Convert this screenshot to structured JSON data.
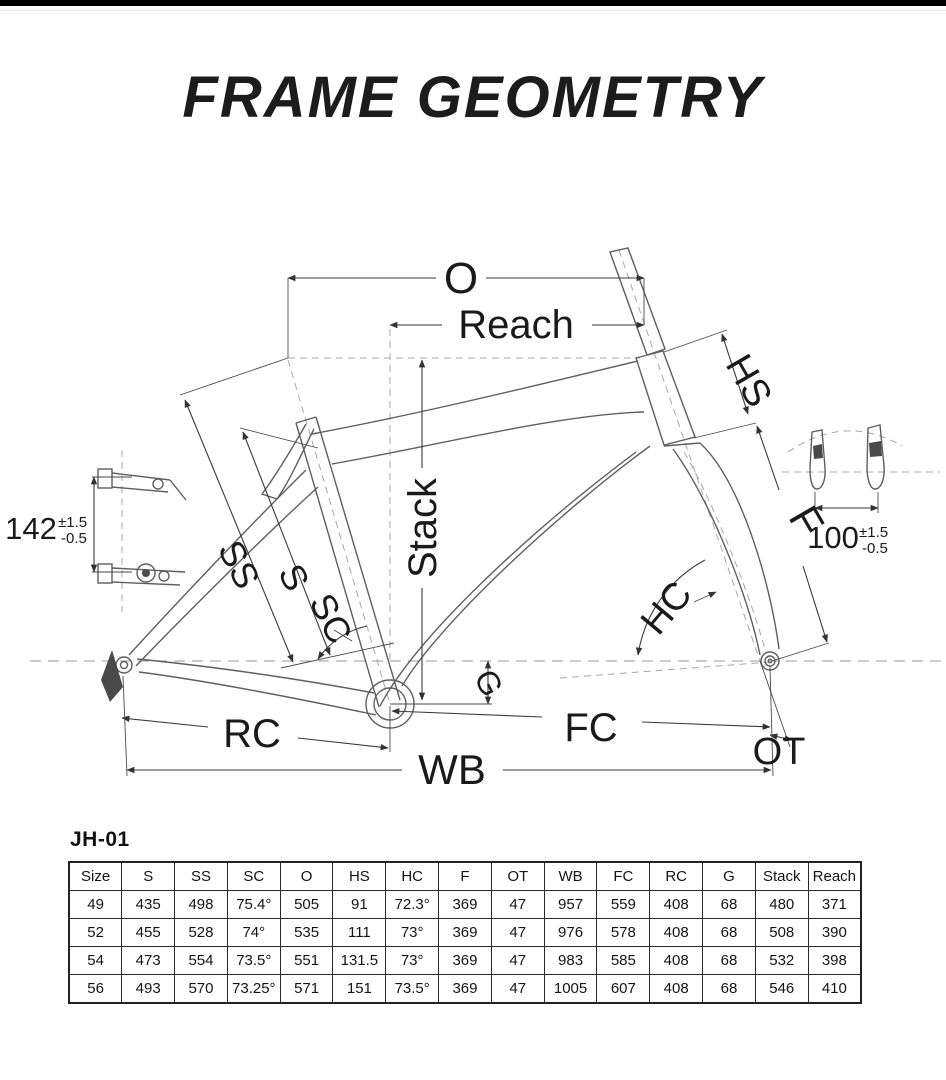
{
  "page": {
    "title": "FRAME GEOMETRY"
  },
  "colors": {
    "background": "#ffffff",
    "top_bar": "#000000",
    "ink": "#1a1a1a",
    "frame_line": "#5f5f5f",
    "dim_line": "#3a3a3a",
    "dash_line": "#9a9a9a"
  },
  "diagram": {
    "dims": {
      "o": "O",
      "reach": "Reach",
      "hs": "HS",
      "f": "F",
      "stack": "Stack",
      "ss": "SS",
      "s": "S",
      "sc": "SC",
      "g": "G",
      "hc": "HC",
      "rc": "RC",
      "fc": "FC",
      "ot": "OT",
      "wb": "WB"
    },
    "rear_hub": {
      "value": "142",
      "tol_plus": "±1.5",
      "tol_minus": "-0.5"
    },
    "front_hub": {
      "value": "100",
      "tol_plus": "±1.5",
      "tol_minus": "-0.5"
    }
  },
  "table": {
    "model": "JH-01",
    "columns": [
      "Size",
      "S",
      "SS",
      "SC",
      "O",
      "HS",
      "HC",
      "F",
      "OT",
      "WB",
      "FC",
      "RC",
      "G",
      "Stack",
      "Reach"
    ],
    "rows": [
      [
        "49",
        "435",
        "498",
        "75.4°",
        "505",
        "91",
        "72.3°",
        "369",
        "47",
        "957",
        "559",
        "408",
        "68",
        "480",
        "371"
      ],
      [
        "52",
        "455",
        "528",
        "74°",
        "535",
        "111",
        "73°",
        "369",
        "47",
        "976",
        "578",
        "408",
        "68",
        "508",
        "390"
      ],
      [
        "54",
        "473",
        "554",
        "73.5°",
        "551",
        "131.5",
        "73°",
        "369",
        "47",
        "983",
        "585",
        "408",
        "68",
        "532",
        "398"
      ],
      [
        "56",
        "493",
        "570",
        "73.25°",
        "571",
        "151",
        "73.5°",
        "369",
        "47",
        "1005",
        "607",
        "408",
        "68",
        "546",
        "410"
      ]
    ]
  }
}
